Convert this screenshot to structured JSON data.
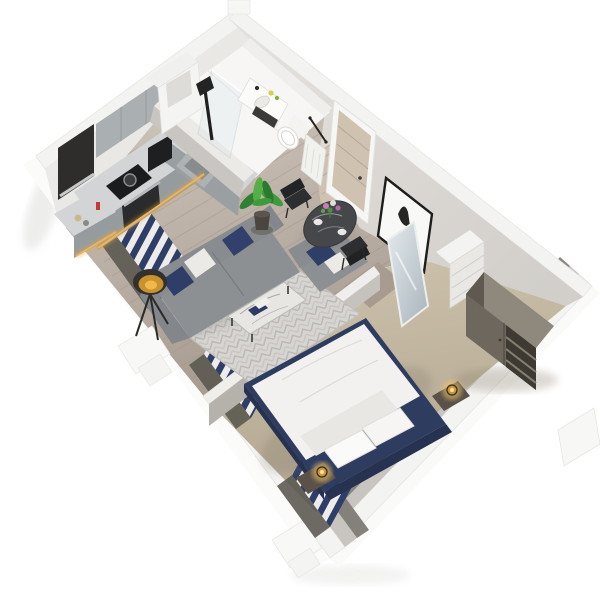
{
  "scene": {
    "title": "Isometric 3D cutaway floor plan render of a one-bedroom apartment",
    "view": "isometric top-down cutaway",
    "background_color": "#ffffff"
  },
  "palette": {
    "wall_top": "#f3f3f1",
    "wall_face_ne": "#dcd9d5",
    "wall_face_nw": "#edecea",
    "wall_inner_low": "#8a8781",
    "wood_floor": "#bdb1a6",
    "carpet": "#c3b7a1",
    "bathroom_floor": "#f6f5f3",
    "cabinet_front": "#99a0a2",
    "cabinet_upper": "#aab0b1",
    "counter_top": "#d2d4d5",
    "appliance_black": "#1c1d1e",
    "steel": "#b9bcbe",
    "glow_amber": "#e7a93c",
    "sofa_gray": "#8d9093",
    "pillow_navy": "#2f3e66",
    "pillow_white": "#eceae7",
    "rug": "#d7d5d2",
    "marble_dark": "#45474a",
    "chair_black": "#2c2e30",
    "bed_navy": "#2e3c60",
    "bedding_white": "#f2f1ef",
    "lamp_gold": "#cf9733",
    "wardrobe_wood": "#6e675d",
    "mirror": "#c6d0d5",
    "plant_green": "#3f9b3a",
    "plant_pot": "#4a463f",
    "door_wood": "#cfc2b0",
    "tv_screen_sky": "#6f9cc8",
    "tv_screen_sunset": "#c8874a",
    "curtain_navy": "#2f3e66",
    "curtain_white": "#edecea"
  },
  "rooms": [
    {
      "id": "kitchen",
      "position": "top-left",
      "floor": "wood",
      "items": [
        "upper-cabinets",
        "l-shaped-counter",
        "induction-cooktop",
        "pot",
        "oven",
        "sink",
        "coffee-machine",
        "under-cabinet-amber-lighting",
        "dark-window-recess",
        "jars",
        "red-bottle"
      ]
    },
    {
      "id": "bathroom",
      "position": "top-center",
      "floor": "white-tile",
      "items": [
        "walk-in-glass-shower",
        "black-shower-column",
        "vanity-basin",
        "toiletries",
        "toilet",
        "black-towel-rail",
        "white-storage-unit",
        "open-wood-door"
      ]
    },
    {
      "id": "living-room",
      "position": "center-left",
      "floor": "wood",
      "items": [
        "grey-sofa",
        "grey-armchair",
        "navy-pillows",
        "white-pillows",
        "patterned-rug",
        "marble-coffee-table",
        "books",
        "tripod-bowl-floor-lamp",
        "wall-tv",
        "tv-console",
        "windows-with-navy-white-curtains"
      ]
    },
    {
      "id": "dining-area",
      "position": "center",
      "floor": "wood",
      "items": [
        "round-dark-marble-table",
        "flower-bouquet",
        "black-chair-left",
        "black-chair-right",
        "potted-plant"
      ]
    },
    {
      "id": "hallway",
      "position": "right",
      "floor": "wood",
      "items": [
        "entrance-door",
        "framed-bird-artwork",
        "radiator",
        "mirrored-closet-door",
        "closet-nook",
        "white-shelf-unit"
      ]
    },
    {
      "id": "bedroom",
      "position": "bottom-right",
      "floor": "beige-carpet",
      "items": [
        "double-bed-navy-frame",
        "white-duvet",
        "white-pillows",
        "navy-headboard",
        "bedside-table-left",
        "bedside-table-right",
        "gold-table-lamp-left",
        "gold-table-lamp-right",
        "wardrobe-with-open-shelves",
        "wall-tv-cityscape",
        "windows-with-navy-white-curtains"
      ]
    }
  ],
  "exterior": {
    "items": [
      "white-structural-block-west",
      "white-structural-block-south",
      "white-structural-block-east",
      "white-structural-block-north",
      "cut-wall-tops"
    ]
  }
}
